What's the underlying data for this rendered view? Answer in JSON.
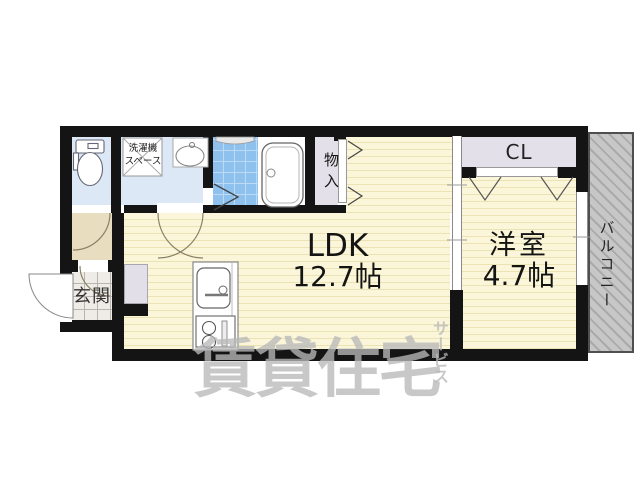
{
  "rooms": {
    "ldk": {
      "label": "LDK",
      "size": "12.7帖"
    },
    "western_room": {
      "label": "洋室",
      "size": "4.7帖"
    },
    "closet": {
      "label": "CL"
    },
    "storage": {
      "label": "物入"
    },
    "entrance": {
      "label": "玄関"
    },
    "washer_space": {
      "line1": "洗濯機",
      "line2": "スペース"
    },
    "balcony": {
      "label": "バルコニー"
    }
  },
  "watermark": {
    "main": "賃貸住宅",
    "sub": "サービス"
  },
  "colors": {
    "wall": "#141414",
    "tatami_yellow": "#fbf6d9",
    "tatami_stripe": "#ece3b5",
    "wet_room_blue": "#dce8f5",
    "bath_tile_blue": "#8ec1ee",
    "closet_gray": "#e3e0e9",
    "hall_beige": "#e9ddc0",
    "balcony_gray": "#c7c7c7",
    "watermark_gray": "#b9b9b9"
  }
}
